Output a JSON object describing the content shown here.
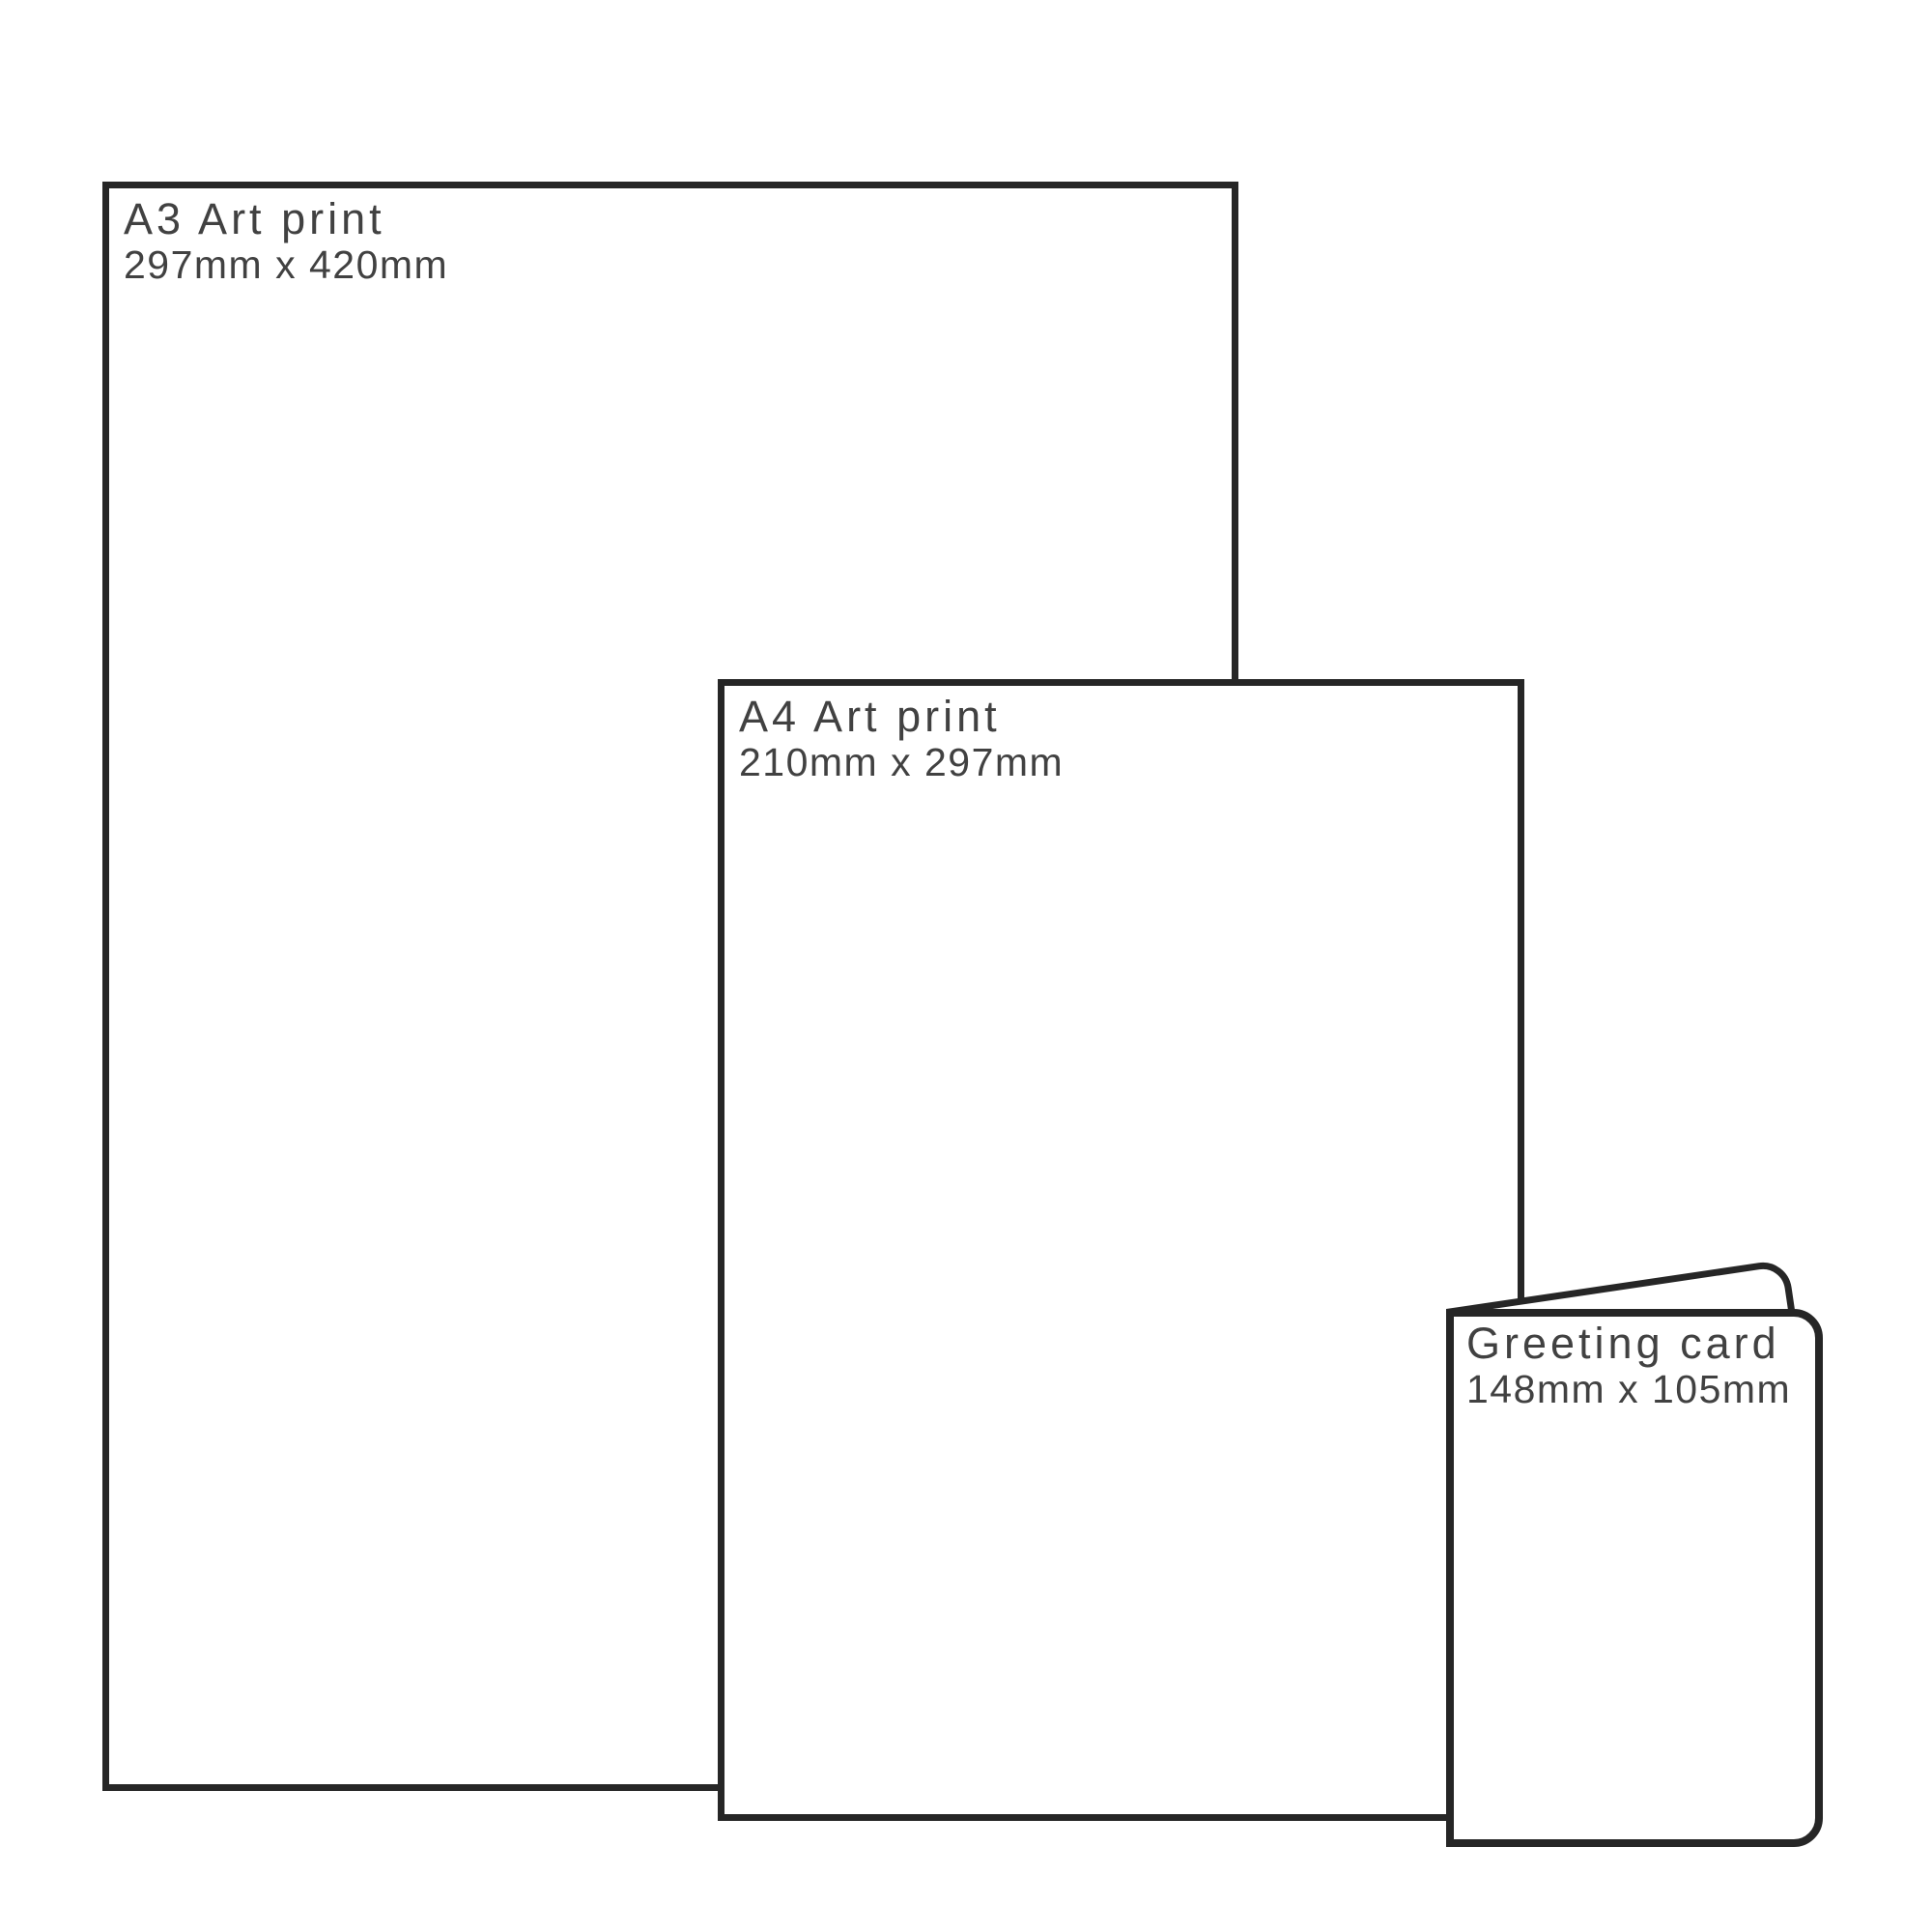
{
  "page": {
    "background": "#ffffff",
    "outline_color": "#262626",
    "text_color": "#414141"
  },
  "sizes": [
    {
      "title": "A3 Art print",
      "dimensions": "297mm x 420mm"
    },
    {
      "title": "A4 Art print",
      "dimensions": "210mm x 297mm"
    },
    {
      "title": "Greeting card",
      "dimensions": "148mm x 105mm"
    }
  ]
}
